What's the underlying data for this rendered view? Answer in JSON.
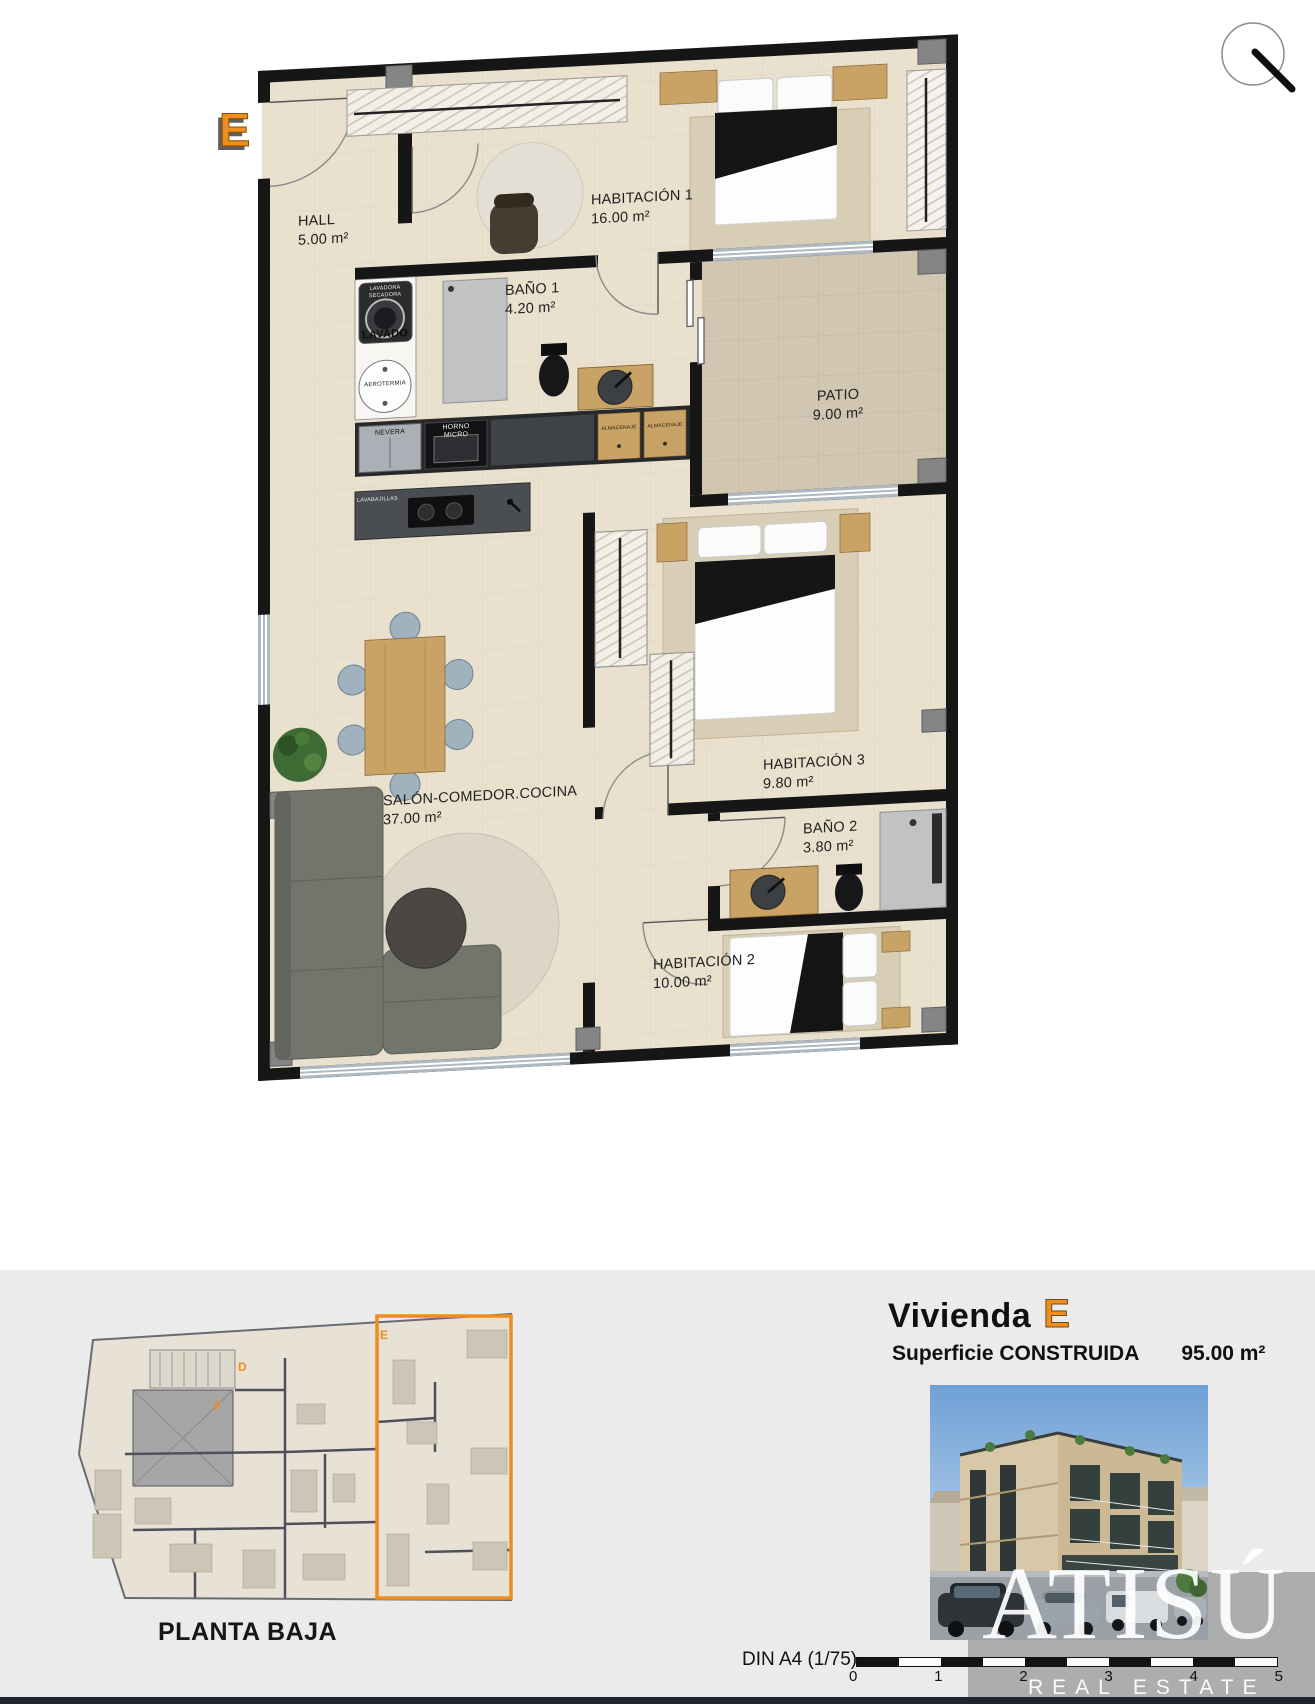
{
  "badge": {
    "letter": "E"
  },
  "plan": {
    "rooms": [
      {
        "name": "HALL",
        "area": "5.00 m²"
      },
      {
        "name": "HABITACIÓN 1",
        "area": "16.00 m²"
      },
      {
        "name": "BAÑO 1",
        "area": "4.20 m²"
      },
      {
        "name": "PATIO",
        "area": "9.00 m²"
      },
      {
        "name": "HABITACIÓN 3",
        "area": "9.80 m²"
      },
      {
        "name": "BAÑO 2",
        "area": "3.80 m²"
      },
      {
        "name": "HABITACIÓN 2",
        "area": "10.00 m²"
      },
      {
        "name": "SALÓN-COMEDOR.COCINA",
        "area": "37.00 m²"
      }
    ],
    "appliances": {
      "lavadora": "LAVADORA",
      "secadora": "SECADORA",
      "lavado": "LAVADO",
      "aerotermia": "AEROTERMIA",
      "nevera": "NEVERA",
      "horno": "HORNO",
      "micro": "MICRO",
      "almacenaje_1": "ALMACENAJE",
      "almacenaje_2": "ALMACENAJE",
      "lavabajillas": "LAVABAJILLAS"
    }
  },
  "overview": {
    "caption": "PLANTA BAJA",
    "unit_e": "E",
    "unit_d": "D",
    "unit_f": "F"
  },
  "info": {
    "title_prefix": "Vivienda",
    "title_unit": "E",
    "surface_label": "Superficie CONSTRUIDA",
    "surface_value": "95.00 m²"
  },
  "scalebar": {
    "label": "DIN A4 (1/75)",
    "ticks": [
      "0",
      "1",
      "2",
      "3",
      "4",
      "5"
    ]
  },
  "watermark": {
    "brand": "ATISÚ",
    "tagline": "REAL ESTATE"
  }
}
